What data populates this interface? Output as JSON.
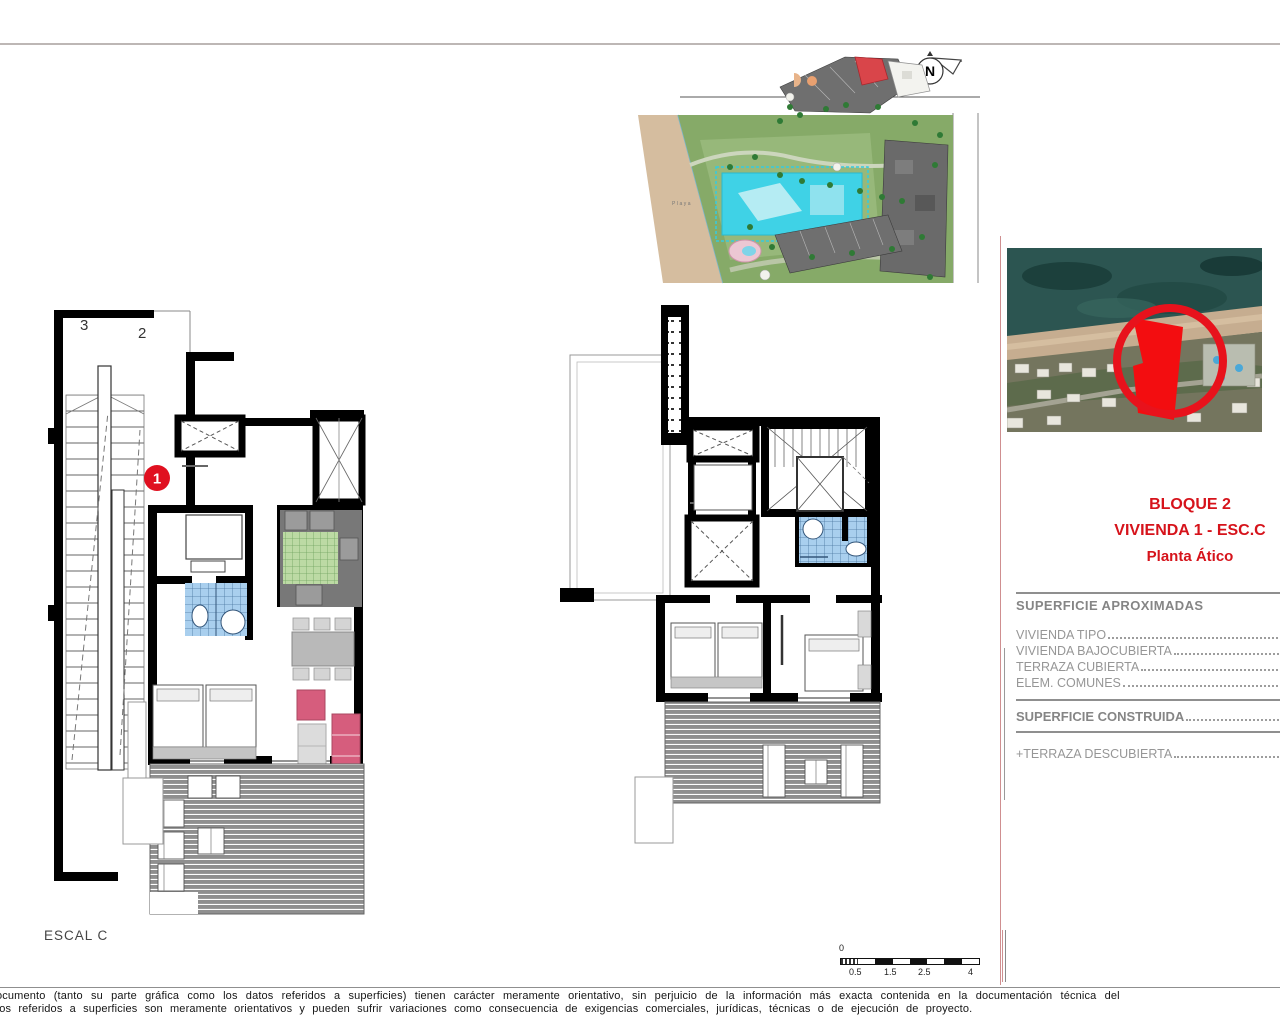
{
  "colors": {
    "accent_red": "#d6131b",
    "marker_red": "#e01020",
    "pool_cyan": "#3fd2e6",
    "wall_black": "#000000",
    "terrace_gray": "#8f8f8f",
    "tile_blue": "#a9cfee",
    "tile_green": "#bcdaa4",
    "sofa_pink": "#d65d7d",
    "beach_tan": "#d5bd9f"
  },
  "site_plan": {
    "playa_label": "Playa",
    "north_label": "N"
  },
  "plans": {
    "left": {
      "landing_label_3": "3",
      "landing_label_2": "2",
      "unit_marker": "1",
      "caption": "ESCAL C"
    }
  },
  "right_panel": {
    "title_line1": "BLOQUE 2",
    "title_line2": "VIVIENDA 1 - ESC.C",
    "title_line3": "Planta Ático",
    "surface_heading": "SUPERFICIE APROXIMADAS",
    "surface_rows": [
      {
        "label": "VIVIENDA TIPO"
      },
      {
        "label": "VIVIENDA BAJOCUBIERTA"
      },
      {
        "label": "TERRAZA CUBIERTA"
      },
      {
        "label": "ELEM. COMUNES"
      }
    ],
    "total_label": "SUPERFICIE CONSTRUIDA",
    "extra_label": "+TERRAZA DESCUBIERTA"
  },
  "scale_bar": {
    "zero": "0",
    "tick_labels": [
      "0.5",
      "1.5",
      "2.5",
      "4"
    ]
  },
  "footer": {
    "line1": "ocumento (tanto su parte gráfica como los datos referidos a superficies) tienen carácter meramente orientativo, sin perjuicio de la información más exacta contenida en la documentación técnica del",
    "line2": "tos referidos a superficies son meramente orientativos y pueden sufrir variaciones como consecuencia de exigencias comerciales, jurídicas, técnicas o de ejecución de proyecto."
  }
}
